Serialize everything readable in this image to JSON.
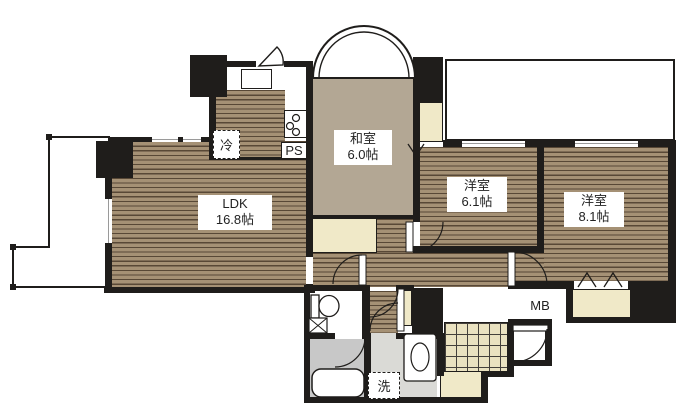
{
  "floorplan": {
    "rooms": [
      {
        "label": "LDK",
        "size": "16.8帖"
      },
      {
        "label": "和室",
        "size": "6.0帖"
      },
      {
        "label": "洋室",
        "size": "6.1帖"
      },
      {
        "label": "洋室",
        "size": "8.1帖"
      }
    ],
    "fixtures": {
      "refrigerator": "冷",
      "pipe_shaft": "PS",
      "meter_box": "MB",
      "laundry": "洗"
    },
    "colors": {
      "wall": "#1f1d1b",
      "flooring": "#a59175",
      "flooring_line": "#584836",
      "tatami": "#b3a794",
      "closet": "#f0e9c8",
      "entry_tile": "#eae2c0",
      "bath": "#c8c8c8",
      "washroom": "#dadad6"
    }
  }
}
